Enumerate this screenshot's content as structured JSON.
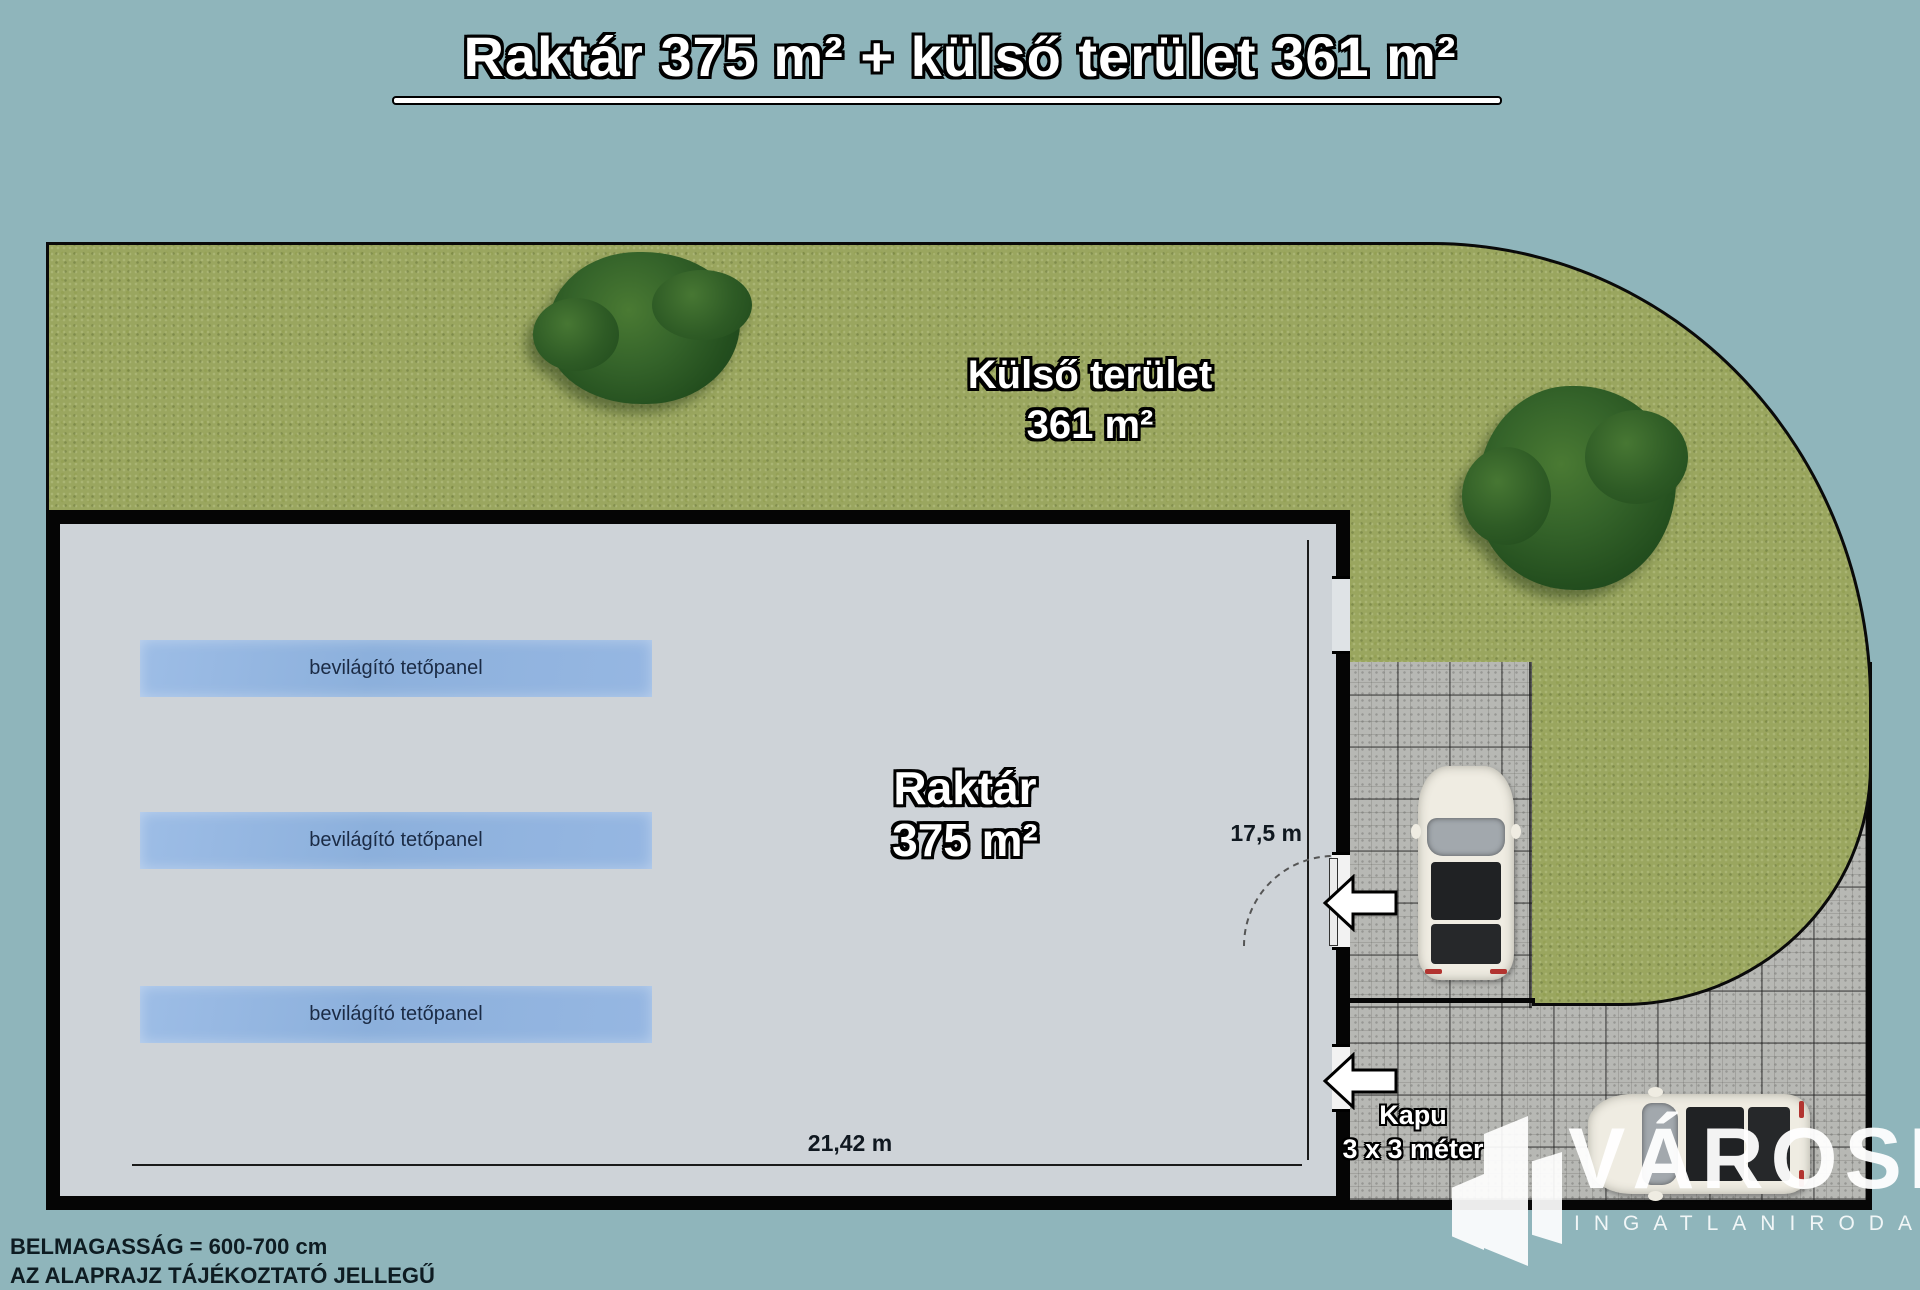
{
  "title": {
    "text": "Raktár 375 m² + külső terület 361 m²"
  },
  "outdoor": {
    "name": "Külső terület",
    "area": "361 m²"
  },
  "warehouse": {
    "name": "Raktár",
    "area": "375 m²",
    "skylight_label": "bevilágító tetőpanel",
    "dim_width": "21,42 m",
    "dim_height": "17,5 m"
  },
  "gate": {
    "name": "Kapu",
    "size": "3 x 3 méter"
  },
  "notes": {
    "line1": "BELMAGASSÁG = 600-700 cm",
    "line2": "AZ ALAPRAJZ TÁJÉKOZTATÓ JELLEGŰ"
  },
  "watermark": {
    "brand": "VÁROSI",
    "subtitle": "INGATLANIRODA"
  },
  "icons": [
    "left-arrow-icon",
    "building-icon",
    "tree",
    "car-top-view"
  ],
  "colors": {
    "background": "#8fb5bb",
    "grass": "#9aa65f",
    "tree": "#2e5b25",
    "paving": "#b7b8b4",
    "warehouse_interior": "#ced3d8",
    "wall": "#050505",
    "skylight_panel": "#8fb2dd",
    "skylight_text": "#1b2b45",
    "label_text": "#ffffff",
    "label_outline": "#000000",
    "taillight": "#b23430"
  }
}
